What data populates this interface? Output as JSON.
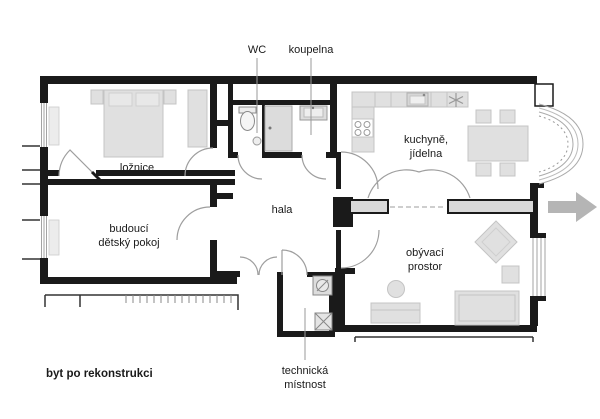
{
  "caption": "byt po rekonstrukci",
  "labels": {
    "wc": "WC",
    "bathroom": "koupelna",
    "bedroom": "ložnice",
    "children_room_line1": "budoucí",
    "children_room_line2": "dětský pokoj",
    "hall": "hala",
    "kitchen_line1": "kuchyně,",
    "kitchen_line2": "jídelna",
    "living_line1": "obývací",
    "living_line2": "prostor",
    "utility_line1": "technická",
    "utility_line2": "místnost"
  },
  "colors": {
    "wall": "#1a1a1a",
    "furniture_fill": "#e0e0e0",
    "furniture_stroke": "#c4c4c4",
    "door_arc": "#9e9e9e",
    "arrow": "#b5b5b5",
    "text": "#1a1a1a",
    "background": "#ffffff"
  }
}
